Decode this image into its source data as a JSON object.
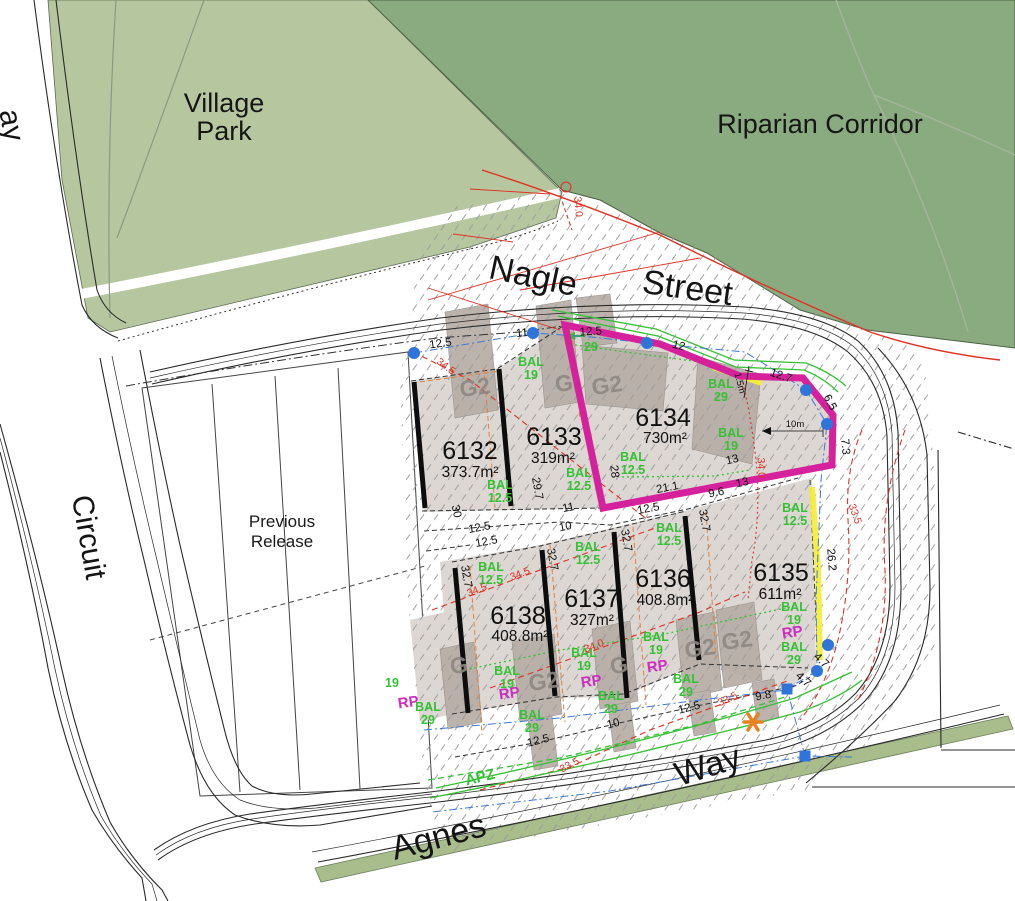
{
  "labels": {
    "village_park_1": "Village",
    "village_park_2": "Park",
    "riparian_corridor": "Riparian Corridor",
    "nagle": "Nagle",
    "street": "Street",
    "circuit": "Circuit",
    "agnes": "Agnes",
    "way": "Way",
    "previous_1": "Previous",
    "previous_2": "Release",
    "left_street_fragment": "ay",
    "apz": "APZ"
  },
  "annotations": {
    "m10": "10m",
    "m15": "1.5m"
  },
  "lots": [
    {
      "id": "6132",
      "area": "373.7m²"
    },
    {
      "id": "6133",
      "area": "319m²"
    },
    {
      "id": "6134",
      "area": "730m²"
    },
    {
      "id": "6135",
      "area": "611m²"
    },
    {
      "id": "6136",
      "area": "408.8m²"
    },
    {
      "id": "6137",
      "area": "327m²"
    },
    {
      "id": "6138",
      "area": "408.8m²"
    }
  ],
  "dims": [
    "12.5",
    "11.1",
    "12.5",
    "12",
    "12.7",
    "6.5",
    "7.3",
    "13",
    "13",
    "21.1",
    "9.6",
    "12.5",
    "28",
    "29.7",
    "30",
    "11",
    "10",
    "12.5",
    "12.5",
    "32.7",
    "32.7",
    "32.7",
    "32.7",
    "26.2",
    "12.5",
    "10",
    "12.5",
    "9.8",
    "4.7",
    "4.7"
  ],
  "bal_word": "BAL",
  "bal_values": [
    "12.5",
    "19",
    "12.5",
    "29",
    "19",
    "12.5",
    "12.5",
    "19",
    "29",
    "12.5",
    "19",
    "29",
    "12.5",
    "19",
    "29",
    "12.5",
    "19",
    "29",
    "29"
  ],
  "green_extras": [
    "29",
    "19"
  ],
  "g2_values": [
    "G2",
    "G",
    "G2",
    "G",
    "G2",
    "G",
    "G2",
    "G2"
  ],
  "rp_label": "RP",
  "red_values": [
    "34.5",
    "34.5",
    "34.5",
    "34.0",
    "34.0",
    "33.5",
    "33.5",
    "33.5",
    "34.0"
  ],
  "colors": {
    "park": "#b6c79f",
    "riparian": "#8aaa7f",
    "verge": "#a9bc8b",
    "lot_fill": "#dcd7d3",
    "building": "#b6ada6",
    "hatch": "#9a9a9a",
    "magenta": "#d6219c",
    "bal_green": "#35c135",
    "red": "#e03024",
    "orange_dash": "#e2813c",
    "blue": "#2f74d9",
    "yellow": "#f4ee3b",
    "asterisk_orange": "#e8821e",
    "rp_magenta": "#cb2fbf"
  }
}
